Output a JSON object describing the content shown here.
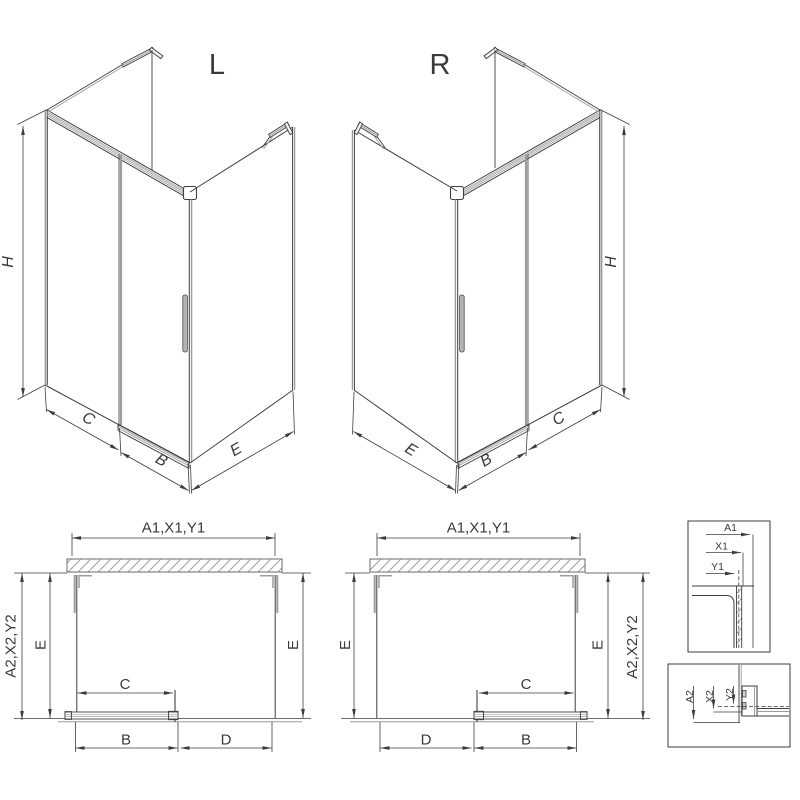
{
  "drawing": {
    "background_color": "#ffffff",
    "line_color": "#3e3e3e",
    "secondary_line_color": "#9c9c9c",
    "handle_fill_color": "#b3b3b3",
    "views": {
      "iso_left": {
        "title": "L",
        "dim_height": "H",
        "dim_fixed_panel": "C",
        "dim_door": "B",
        "dim_side_wall": "E"
      },
      "iso_right": {
        "title": "R",
        "dim_height": "H",
        "dim_fixed_panel": "C",
        "dim_door": "B",
        "dim_side_wall": "E"
      },
      "plan_left": {
        "dim_top": "A1,X1,Y1",
        "dim_outer_side": "A2,X2,Y2",
        "dim_depth_left": "E",
        "dim_depth_right": "E",
        "dim_clear_width": "C",
        "dim_door_width": "B",
        "dim_opening": "D"
      },
      "plan_right": {
        "dim_top": "A1,X1,Y1",
        "dim_outer_side": "A2,X2,Y2",
        "dim_depth_left": "E",
        "dim_depth_right": "E",
        "dim_clear_width": "C",
        "dim_opening": "D",
        "dim_door_width": "B"
      },
      "detail_top": {
        "dim_a": "A1",
        "dim_x": "X1",
        "dim_y": "Y1"
      },
      "detail_bottom": {
        "dim_a": "A2",
        "dim_x": "X2",
        "dim_y": "Y2"
      }
    }
  }
}
